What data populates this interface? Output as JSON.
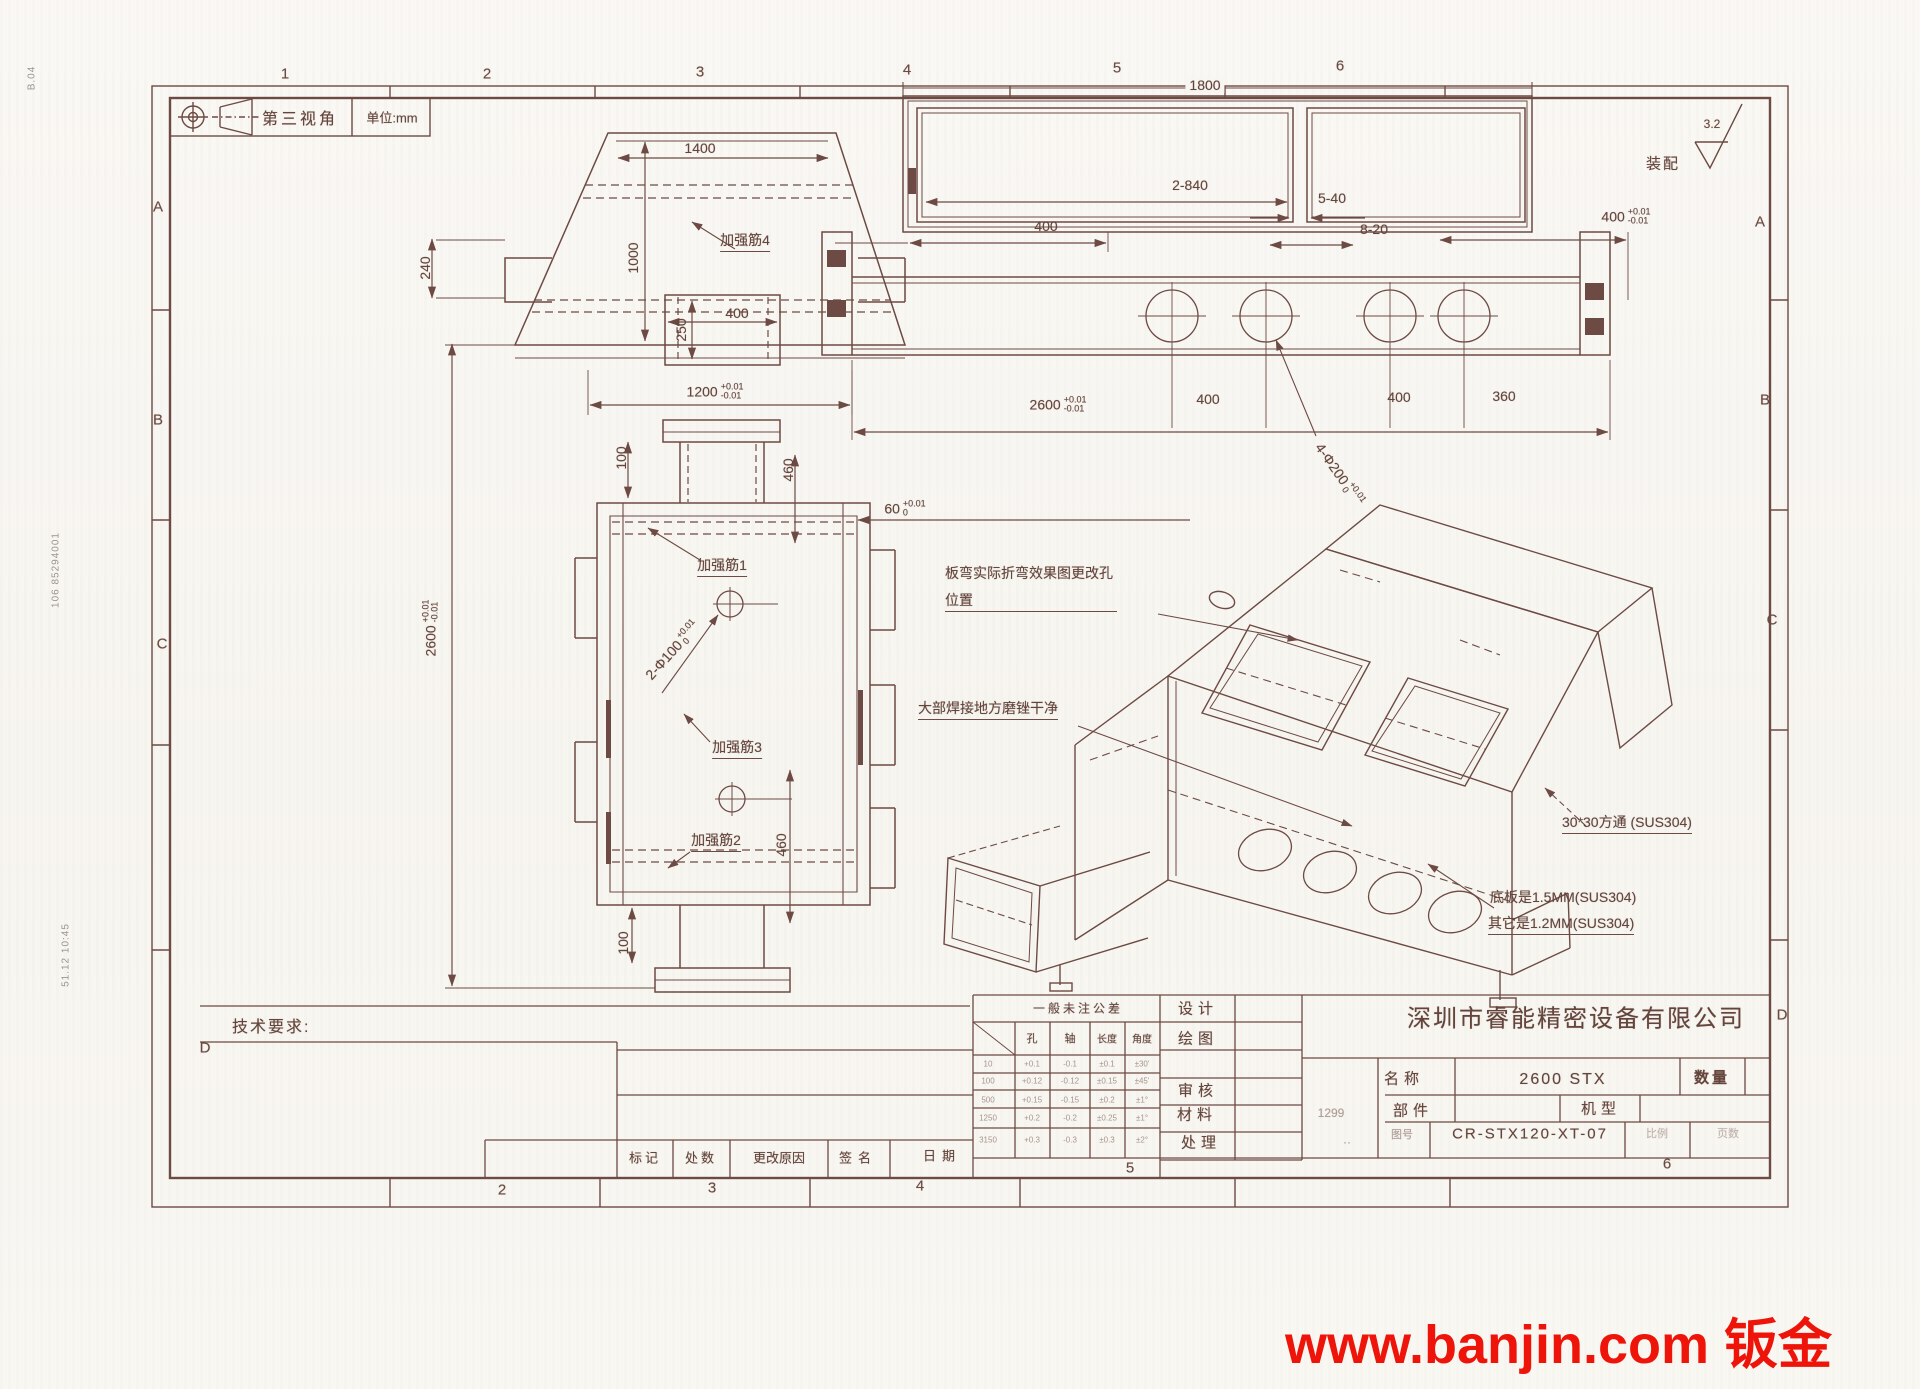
{
  "watermark": {
    "text": "www.banjin.com 钣金",
    "color": "#ee1409"
  },
  "frame": {
    "zones_top": [
      "1",
      "2",
      "3",
      "4",
      "5",
      "6"
    ],
    "zones_bottom": [
      "2",
      "3",
      "4",
      "5"
    ],
    "rows_left": [
      "A",
      "B",
      "C",
      "D"
    ],
    "rows_right": [
      "A",
      "B",
      "C",
      "D"
    ]
  },
  "header": {
    "projection": "第三视角",
    "unit": "单位:mm",
    "assembly": "装配",
    "roughness": "3.2"
  },
  "margin_marks": [
    "B.04",
    "106 85294001",
    "51.12 10:45"
  ],
  "top_view": {
    "dim_width_top": "1400",
    "dim_height": "1000",
    "dim_left": "240",
    "dim_neck_h": "250",
    "dim_neck_w": "400",
    "rib": "加强筋4",
    "dim_bottom": "1200",
    "tol_up": "+0.01",
    "tol_dn": "-0.01"
  },
  "front_view": {
    "dim_100_top": "100",
    "dim_460_top": "460",
    "dim_60": "60",
    "dim_60_tol_up": "+0.01",
    "dim_60_tol_dn": "0",
    "rib1": "加强筋1",
    "holes": "2-Φ100",
    "holes_tol_up": "+0.01",
    "holes_tol_dn": "0",
    "rib3": "加强筋3",
    "rib2": "加强筋2",
    "dim_460_bottom": "460",
    "dim_100_bottom": "100",
    "dim_total": "2600",
    "total_tol_up": "+0.01",
    "total_tol_dn": "-0.01"
  },
  "side_view": {
    "dim_width": "1800",
    "dim_openings": "2-840",
    "dim_5_40": "5-40",
    "dim_8_20": "8-20",
    "dim_400_left": "400",
    "dim_400_right": "400",
    "r_tol_up": "+0.01",
    "r_tol_dn": "-0.01",
    "dim_total": "2600",
    "t_tol_up": "+0.01",
    "t_tol_dn": "-0.01",
    "dim_400_a": "400",
    "dim_400_b": "400",
    "dim_360": "360",
    "holes": "4-Φ200",
    "h_tol_up": "+0.01",
    "h_tol_dn": "0"
  },
  "iso_view": {
    "note_bend_1": "板弯实际折弯效果图更改孔",
    "note_bend_2": "位置",
    "note_weld": "大部焊接地方磨锉干净",
    "note_tube": "30*30方通 (SUS304)",
    "note_plate1": "底板是1.5MM(SUS304)",
    "note_plate2": "其它是1.2MM(SUS304)"
  },
  "tech_req": "技术要求:",
  "revision_row": [
    "标记",
    "处数",
    "更改原因",
    "签名",
    "日期"
  ],
  "tolerance_table": {
    "title": "一般未注公差",
    "columns": [
      "孔",
      "轴",
      "长度",
      "角度"
    ],
    "rows": [
      {
        "range": "10",
        "hole": "+0.1",
        "shaft": "-0.1",
        "length": "±0.1",
        "angle": "±30'"
      },
      {
        "range": "100",
        "hole": "+0.12",
        "shaft": "-0.12",
        "length": "±0.15",
        "angle": "±45'"
      },
      {
        "range": "500",
        "hole": "+0.15",
        "shaft": "-0.15",
        "length": "±0.2",
        "angle": "±1°"
      },
      {
        "range": "1250",
        "hole": "+0.2",
        "shaft": "-0.2",
        "length": "±0.25",
        "angle": "±1°"
      },
      {
        "range": "3150",
        "hole": "+0.3",
        "shaft": "-0.3",
        "length": "±0.3",
        "angle": "±2°"
      }
    ]
  },
  "title_block": {
    "company": "深圳市睿能精密设备有限公司",
    "design_label": "设计",
    "draw_label": "绘图",
    "check_label": "审核",
    "material_label": "材料",
    "material_value": "1299",
    "treat_label": "处理",
    "treat_value": "··",
    "name_label": "名称",
    "name_value": "2600 STX",
    "qty_label": "数量",
    "part_label": "部件",
    "model_label": "机型",
    "no_label": "图号",
    "drawing_no": "CR-STX120-XT-07",
    "scale_label": "比例",
    "sheet_label": "页数",
    "page_value": "6"
  }
}
